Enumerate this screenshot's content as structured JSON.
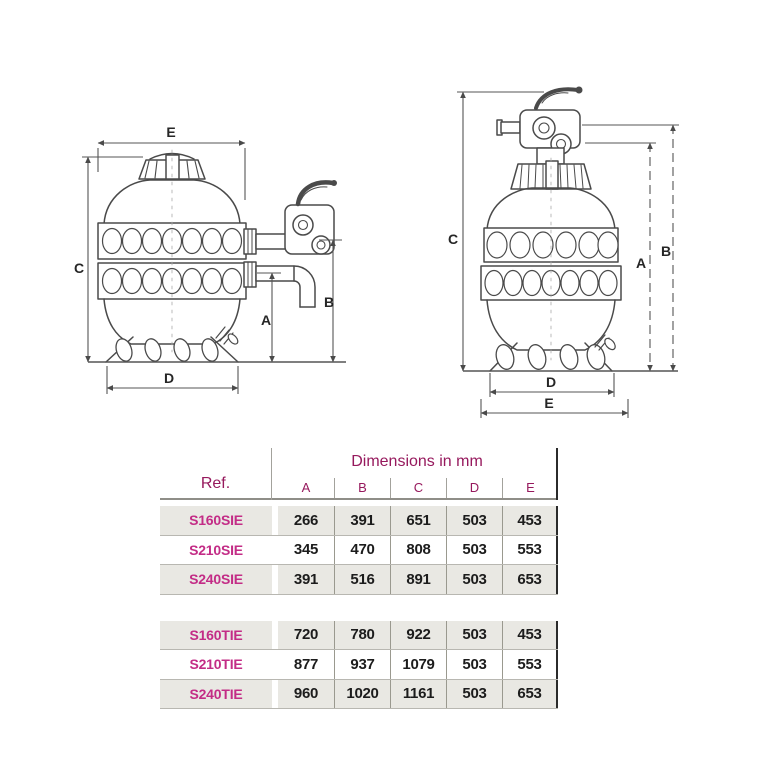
{
  "diagrams": {
    "left": {
      "title": "side-mount sand filter drawing",
      "labels": {
        "e": "E",
        "c": "C",
        "a": "A",
        "b": "B",
        "d": "D"
      }
    },
    "right": {
      "title": "top-mount sand filter drawing",
      "labels": {
        "c": "C",
        "a": "A",
        "b": "B",
        "d": "D",
        "e": "E"
      }
    }
  },
  "table": {
    "ref_header": "Ref.",
    "dimensions_header": "Dimensions in mm",
    "columns": [
      "A",
      "B",
      "C",
      "D",
      "E"
    ],
    "groups": [
      {
        "rows": [
          {
            "ref": "S160SIE",
            "values": [
              "266",
              "391",
              "651",
              "503",
              "453"
            ]
          },
          {
            "ref": "S210SIE",
            "values": [
              "345",
              "470",
              "808",
              "503",
              "553"
            ]
          },
          {
            "ref": "S240SIE",
            "values": [
              "391",
              "516",
              "891",
              "503",
              "653"
            ]
          }
        ]
      },
      {
        "rows": [
          {
            "ref": "S160TIE",
            "values": [
              "720",
              "780",
              "922",
              "503",
              "453"
            ]
          },
          {
            "ref": "S210TIE",
            "values": [
              "877",
              "937",
              "1079",
              "503",
              "553"
            ]
          },
          {
            "ref": "S240TIE",
            "values": [
              "960",
              "1020",
              "1161",
              "503",
              "653"
            ]
          }
        ]
      }
    ],
    "colors": {
      "header_text": "#96195d",
      "ref_text": "#c32c86",
      "row_shaded": "#e9e8e3",
      "value_text": "#1c1c1c",
      "grid_line": "#a3a29c",
      "right_border": "#2b2b2b"
    }
  }
}
